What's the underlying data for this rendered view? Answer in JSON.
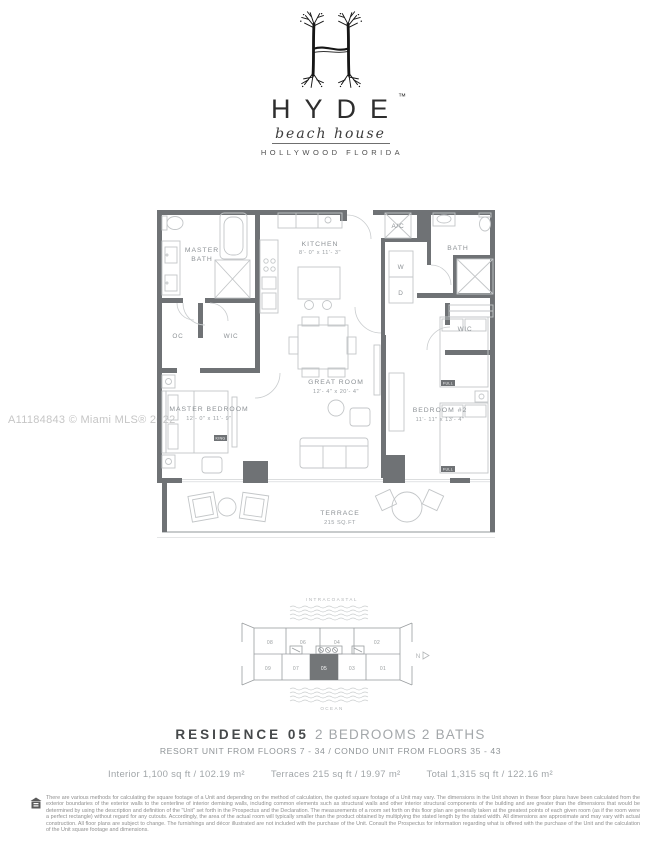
{
  "brand": {
    "name": "HYDE",
    "trademark": "™",
    "script": "beach house",
    "location": "HOLLYWOOD FLORIDA"
  },
  "watermark": "A11184843 © Miami MLS® 2022",
  "floorplan": {
    "wall_color": "#6f7275",
    "furniture_line_color": "#c3c6c8",
    "label_color": "#8d9296",
    "rooms": {
      "master_bath_l1": "MASTER",
      "master_bath_l2": "BATH",
      "oc": "OC",
      "wic_master": "WIC",
      "master_bedroom": "MASTER BEDROOM",
      "master_bedroom_dims": "12'- 0\" x 11'- 9\"",
      "kitchen": "KITCHEN",
      "kitchen_dims": "8'- 0\" x 11'- 3\"",
      "great_room": "GREAT ROOM",
      "great_room_dims": "12'- 4\" x 20'- 4\"",
      "ac": "A/C",
      "washer": "W",
      "dryer": "D",
      "bath2": "BATH",
      "wic2": "WIC",
      "bedroom2": "BEDROOM #2",
      "bedroom2_dims": "11'- 11\" x 13'- 4\"",
      "terrace": "TERRACE",
      "terrace_dims": "215 SQ.FT"
    },
    "bed_tags": {
      "king": "KING",
      "full1": "FULL",
      "full2": "FULL"
    }
  },
  "keyplan": {
    "top_label": "INTRACOASTAL",
    "bottom_label": "OCEAN",
    "north": "N",
    "units_top": [
      "08",
      "06",
      "04",
      "02"
    ],
    "units_bottom": [
      "09",
      "07",
      "05",
      "03",
      "01"
    ],
    "highlighted_unit": "05",
    "highlight_color": "#737678"
  },
  "title": {
    "residence": "RESIDENCE 05",
    "beds_baths": "2 BEDROOMS 2 BATHS",
    "floors": "RESORT UNIT FROM FLOORS 7 - 34 / CONDO UNIT FROM FLOORS 35 - 43",
    "stats": {
      "interior": "Interior 1,100 sq ft / 102.19 m²",
      "terraces": "Terraces 215 sq ft / 19.97 m²",
      "total": "Total 1,315 sq ft / 122.16 m²"
    }
  },
  "disclaimer": {
    "text": "There are various methods for calculating the square footage of a Unit and depending on the method of calculation, the quoted square footage of a Unit may vary.  The dimensions in the Unit shown in these floor plans have been calculated from the exterior boundaries of the exterior walls to the centerline of interior demising walls, including common elements such as structural walls and other interior structural components of the building and are greater than the dimensions that would be determined by using the description and definition of the \"Unit\" set forth in the Prospectus and the Declaration.  The measurements of a room set forth on this floor plan are generally taken at the greatest points of each given room (as if the room were a perfect rectangle) without regard for any cutouts. Accordingly, the area of the actual room will typically smaller than the product obtained by multiplying the stated length by the stated width.  All dimensions are approximate and may vary with actual construction. All floor plans are subject to change.  The furnishings and décor illustrated are not included with the purchase of the Unit.  Consult the Prospectus for information regarding what is offered with the purchase of the Unit and the calculation of the Unit square footage and dimensions."
  }
}
